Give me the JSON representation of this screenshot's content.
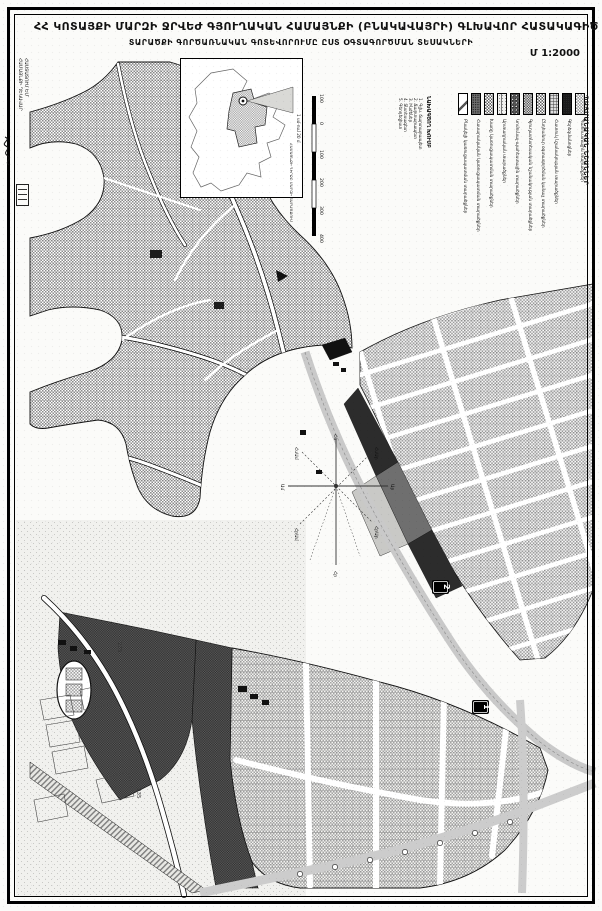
{
  "sheet": {
    "title": "ՀՀ ԿՈՏԱՅՔԻ ՄԱՐԶԻ ՋՐՎԵԺ ԳՅՈՒՂԱԿԱՆ ՀԱՄԱՅՆՔԻ (ԲՆԱԿԱՎԱՅՐԻ) ԳԼԽԱՎՈՐ ՀԱՏԱԿԱԳԻԾ",
    "subtitle": "ՏԱՐԱԾՔԻ ԳՈՐԾԱՌՆԱԿԱՆ ԳՈՏԵՎՈՐՈՒՄԸ ԸՍՏ ՕԳՏԱԳՈՐԾՄԱՆ ՏԵՍԱԿՆԵՐԻ",
    "scale_label": "Մ 1:2000"
  },
  "approval_stamp": {
    "line1": "ՀԱՍՏԱՏՈՒՄ ԵՄ՝",
    "line2": "ՀԱՄԱՅՆՔԻ ՂԵԿԱՎԱՐ"
  },
  "inset": {
    "caption": "ՀԱՄԱՅՆՔԻ ԴԻՐՔԸ ՄԱՐԶԻ ՏԱՐԱԾՔՈՒՄ"
  },
  "scalebar": {
    "caption": "1 սմ-ում 20 մ",
    "ticks": [
      "100",
      "0",
      "100",
      "200",
      "300",
      "400"
    ]
  },
  "team": {
    "heading": "ՆԱԽԱԳԾՈՂ ԽՈՒՄԲ",
    "members": [
      "1. Գլխ. ճարտարապետ",
      "2. Ճարտարապետ",
      "3. Ինժեներ",
      "4. Տնտեսագետ",
      "5. Գեոդեզիստ"
    ]
  },
  "legend": {
    "title": "ՊԱՅՄԱՆԱԿԱՆ ՆՇԱՆՆԵՐ",
    "items": [
      {
        "label": "Բնակելի կառուցապատման տարածքներ"
      },
      {
        "label": "Հասարակական կառուցապատման տարածքներ"
      },
      {
        "label": "Խառը կառուցապատման տարածքներ"
      },
      {
        "label": "Արտադրական տարածքներ"
      },
      {
        "label": "Կոմունալ-պահեստային տարածքներ"
      },
      {
        "label": "Գյուղատնտեսական նշանակության տարածքներ"
      },
      {
        "label": "Ընդհանուր օգտագործման կանաչ տարածքներ"
      },
      {
        "label": "Հատուկ նշանակության տարածքներ"
      },
      {
        "label": "Գերեզմանոցներ"
      },
      {
        "label": "Պահուստային տարածքներ"
      }
    ]
  },
  "compass": {
    "n": "Հս",
    "ne": "ՀսԱր",
    "e": "Ար",
    "se": "ՀրԱր",
    "s": "Հր",
    "sw": "ՀրԱմ",
    "w": "Ամ",
    "nw": "ՀսԱմ"
  },
  "markers": [
    {
      "label": "2"
    },
    {
      "label": "1"
    }
  ],
  "road_labels": [
    "235",
    "235"
  ]
}
